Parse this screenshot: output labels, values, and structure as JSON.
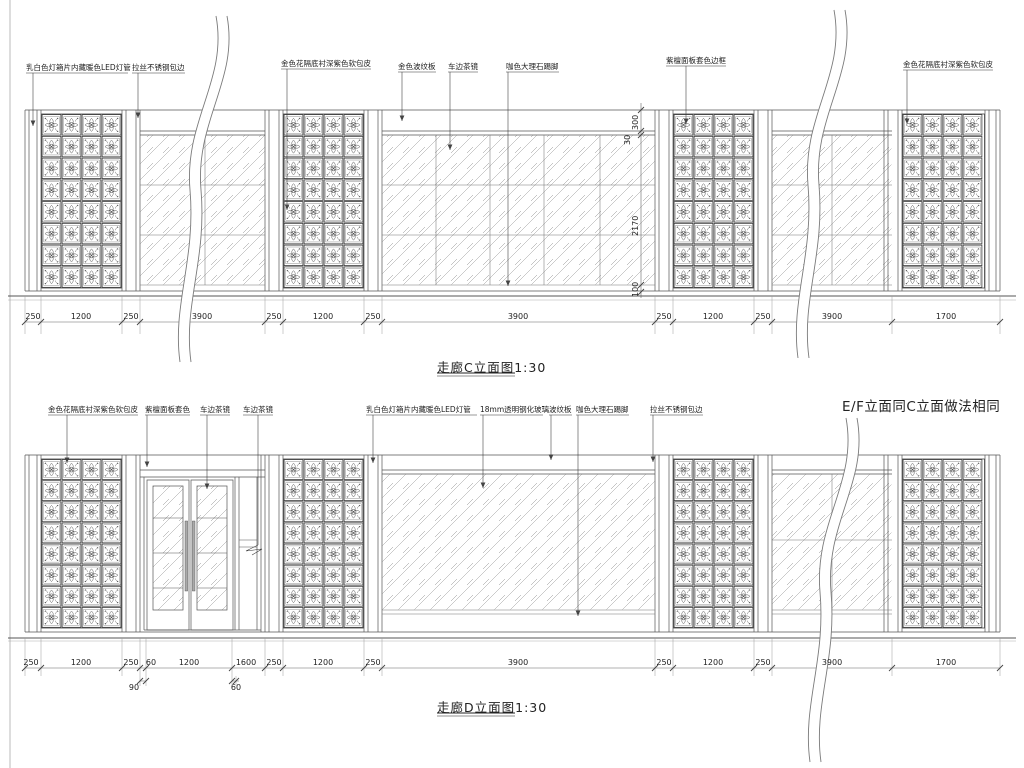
{
  "note": {
    "t": "E/F立面同C立面做法相同",
    "x": 842,
    "y": 395
  },
  "elev_c": {
    "title": {
      "t": "走廊C立面图1:30",
      "x": 437,
      "y": 357
    },
    "labels": [
      {
        "t": "乳白色灯箱片内藏暖色LED灯管",
        "x": 26,
        "y": 62
      },
      {
        "t": "拉丝不锈钢包边",
        "x": 132,
        "y": 62
      },
      {
        "t": "金色花隔底衬深紫色软包皮",
        "x": 281,
        "y": 58
      },
      {
        "t": "金色波纹板",
        "x": 398,
        "y": 61
      },
      {
        "t": "车边茶镜",
        "x": 448,
        "y": 61
      },
      {
        "t": "咖色大理石踢脚",
        "x": 506,
        "y": 61
      },
      {
        "t": "紫檀面板套色边框",
        "x": 666,
        "y": 55
      },
      {
        "t": "金色花隔底衬深紫色软包皮",
        "x": 903,
        "y": 59
      }
    ],
    "dims": [
      {
        "v": "250",
        "x": 33,
        "y": 312
      },
      {
        "v": "1200",
        "x": 81,
        "y": 312
      },
      {
        "v": "250",
        "x": 131,
        "y": 312
      },
      {
        "v": "3900",
        "x": 202,
        "y": 312
      },
      {
        "v": "250",
        "x": 274,
        "y": 312
      },
      {
        "v": "1200",
        "x": 323,
        "y": 312
      },
      {
        "v": "250",
        "x": 373,
        "y": 312
      },
      {
        "v": "3900",
        "x": 518,
        "y": 312
      },
      {
        "v": "250",
        "x": 664,
        "y": 312
      },
      {
        "v": "1200",
        "x": 713,
        "y": 312
      },
      {
        "v": "250",
        "x": 763,
        "y": 312
      },
      {
        "v": "3900",
        "x": 832,
        "y": 312
      },
      {
        "v": "1700",
        "x": 946,
        "y": 312
      }
    ],
    "vdims": [
      {
        "v": "300",
        "x": 640,
        "y": 121
      },
      {
        "v": "30",
        "x": 632,
        "y": 136
      },
      {
        "v": "2170",
        "x": 640,
        "y": 227
      },
      {
        "v": "100",
        "x": 640,
        "y": 288
      }
    ]
  },
  "elev_d": {
    "title": {
      "t": "走廊D立面图1:30",
      "x": 437,
      "y": 697
    },
    "labels": [
      {
        "t": "金色花隔底衬深紫色软包皮",
        "x": 48,
        "y": 404
      },
      {
        "t": "紫檀面板套色",
        "x": 145,
        "y": 404
      },
      {
        "t": "车边茶镜",
        "x": 200,
        "y": 404
      },
      {
        "t": "车边茶镜",
        "x": 243,
        "y": 404
      },
      {
        "t": "乳白色灯箱片内藏暖色LED灯管",
        "x": 366,
        "y": 404
      },
      {
        "t": "18mm透明钢化玻璃",
        "x": 480,
        "y": 404
      },
      {
        "t": "波纹板",
        "x": 549,
        "y": 404
      },
      {
        "t": "咖色大理石踢脚",
        "x": 576,
        "y": 404
      },
      {
        "t": "拉丝不锈钢包边",
        "x": 650,
        "y": 404
      }
    ],
    "dims_row1": [
      {
        "v": "250",
        "x": 31,
        "y": 658
      },
      {
        "v": "1200",
        "x": 81,
        "y": 658
      },
      {
        "v": "250",
        "x": 131,
        "y": 658
      },
      {
        "v": "60",
        "x": 151,
        "y": 658
      },
      {
        "v": "1200",
        "x": 189,
        "y": 658
      },
      {
        "v": "1600",
        "x": 246,
        "y": 658
      },
      {
        "v": "250",
        "x": 274,
        "y": 658
      },
      {
        "v": "1200",
        "x": 323,
        "y": 658
      },
      {
        "v": "250",
        "x": 373,
        "y": 658
      },
      {
        "v": "3900",
        "x": 518,
        "y": 658
      },
      {
        "v": "250",
        "x": 664,
        "y": 658
      },
      {
        "v": "1200",
        "x": 713,
        "y": 658
      },
      {
        "v": "250",
        "x": 763,
        "y": 658
      },
      {
        "v": "3900",
        "x": 832,
        "y": 658
      },
      {
        "v": "1700",
        "x": 946,
        "y": 658
      }
    ],
    "dims_row2": [
      {
        "v": "90",
        "x": 134,
        "y": 683
      },
      {
        "v": "60",
        "x": 236,
        "y": 683
      }
    ]
  }
}
